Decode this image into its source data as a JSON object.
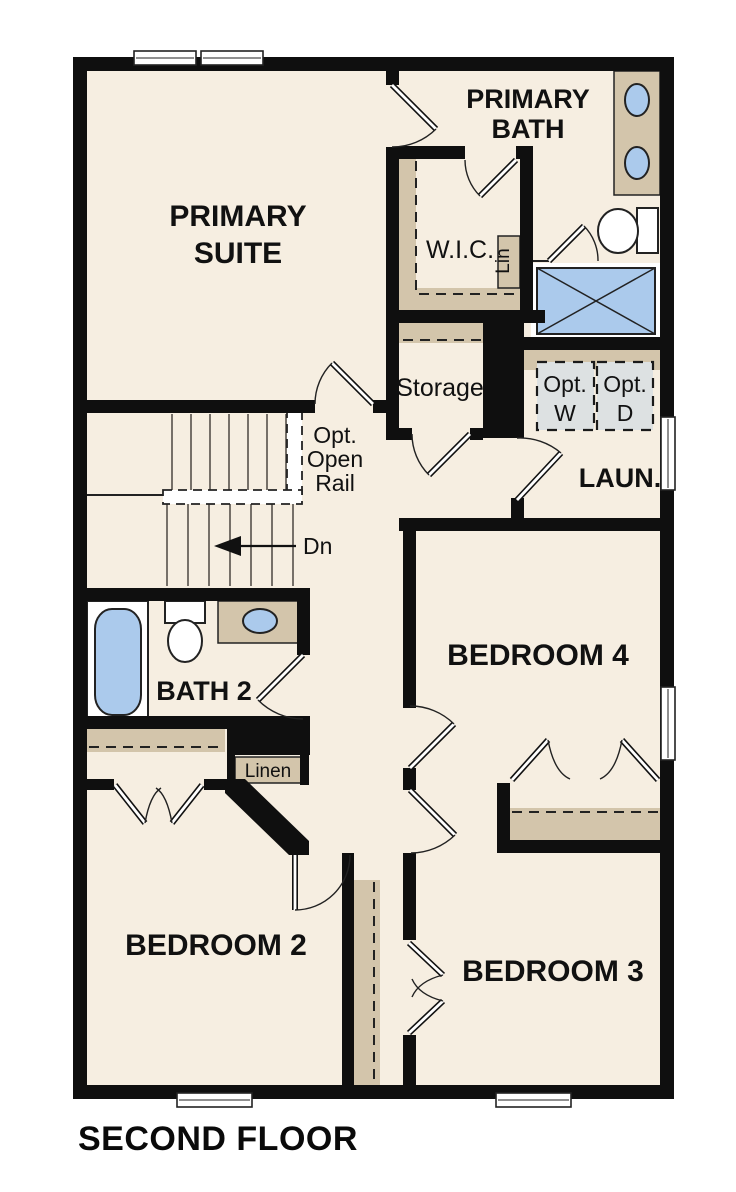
{
  "title": "SECOND FLOOR",
  "rooms": {
    "primary_suite": {
      "line1": "PRIMARY",
      "line2": "SUITE"
    },
    "primary_bath": {
      "line1": "PRIMARY",
      "line2": "BATH"
    },
    "wic": {
      "label": "W.I.C."
    },
    "lin_closet": {
      "label": "Lin"
    },
    "storage": {
      "label": "Storage"
    },
    "laundry": {
      "label": "LAUN."
    },
    "opt_washer": {
      "line1": "Opt.",
      "line2": "W"
    },
    "opt_dryer": {
      "line1": "Opt.",
      "line2": "D"
    },
    "bath2": {
      "label": "BATH 2"
    },
    "linen": {
      "label": "Linen"
    },
    "bedroom4": {
      "label": "BEDROOM 4"
    },
    "bedroom2": {
      "label": "BEDROOM 2"
    },
    "bedroom3": {
      "label": "BEDROOM 3"
    }
  },
  "stairs": {
    "open_rail_line1": "Opt.",
    "open_rail_line2": "Open",
    "open_rail_line3": "Rail",
    "down_label": "Dn"
  },
  "colors": {
    "floor": "#f6eee1",
    "wall": "#0f0f0f",
    "casework_tan": "#d3c5ab",
    "fixture_blue": "#abcaec",
    "appliance_gray": "#dde1e2",
    "window_white": "#ffffff"
  }
}
